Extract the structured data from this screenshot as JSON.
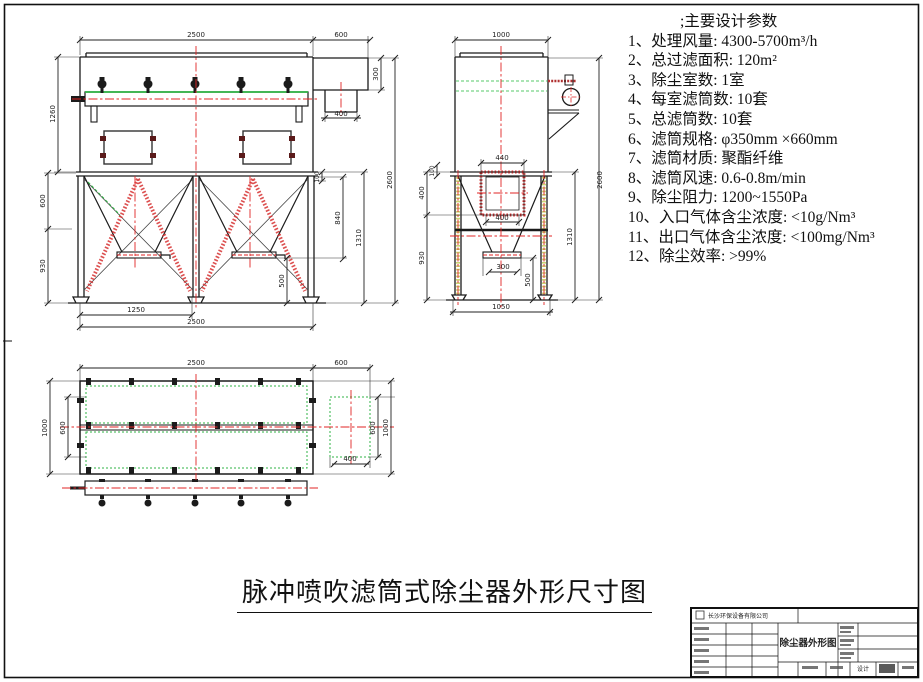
{
  "params": {
    "header": ";主要设计参数",
    "items": [
      "1、处理风量: 4300-5700m³/h",
      "2、总过滤面积: 120m²",
      "3、除尘室数: 1室",
      "4、每室滤筒数: 10套",
      "5、总滤筒数: 10套",
      "6、滤筒规格: φ350mm ×660mm",
      "7、滤筒材质: 聚酯纤维",
      "8、滤筒风速: 0.6-0.8m/min",
      "9、除尘阻力: 1200~1550Pa",
      "10、入口气体含尘浓度: <10g/Nm³",
      "11、出口气体含尘浓度: <100mg/Nm³",
      "12、除尘效率: >99%"
    ]
  },
  "main_title": "脉冲喷吹滤筒式除尘器外形尺寸图",
  "title_block": {
    "company": "长沙环保设备有限公司",
    "drawing_title": "除尘器外形图",
    "design_label": "设计"
  },
  "front_view": {
    "width_top": "2500",
    "outlet_top": "600",
    "outlet_height": "300",
    "outlet_duct": "400",
    "body_height": "1260",
    "left_upper": "600",
    "left_lower": "930",
    "platform_thk": "100",
    "right_inner": "840",
    "right_mid": "1310",
    "right_outer": "2600",
    "hopper_out": "500",
    "bay_width": "1250",
    "width_bottom": "2500"
  },
  "side_view": {
    "width_top": "1000",
    "inlet_top": "440",
    "left_top": "100",
    "inlet_height": "400",
    "left_lower": "930",
    "inlet_bottom": "400",
    "discharge_width": "300",
    "discharge_height": "500",
    "right_inner": "1310",
    "right_outer": "2600",
    "width_bottom": "1050"
  },
  "plan_view": {
    "width_top": "2500",
    "outlet_top": "600",
    "left_outer": "1000",
    "left_inner": "600",
    "right_inner": "600",
    "right_outer": "1000",
    "outlet_width": "400"
  },
  "colors": {
    "line": "#1b1b1b",
    "centerline_red": "#e02525",
    "green": "#2fb344",
    "hatch_red": "#d63030"
  }
}
